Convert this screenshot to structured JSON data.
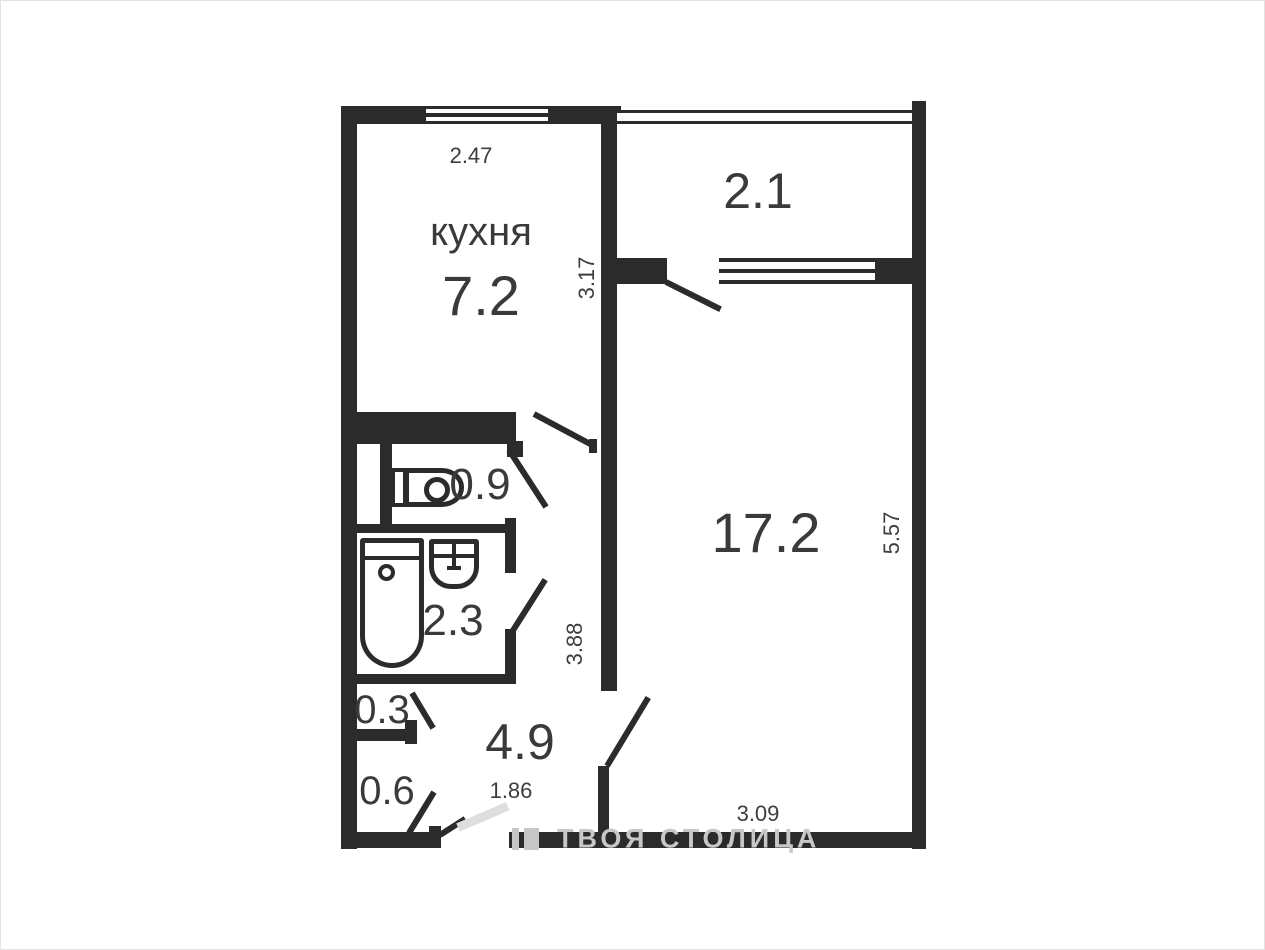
{
  "rooms": {
    "kitchen": {
      "label": "кухня",
      "area": "7.2"
    },
    "balcony": {
      "area": "2.1"
    },
    "living_room": {
      "area": "17.2"
    },
    "wc": {
      "area": "0.9"
    },
    "bathroom": {
      "area": "2.3"
    },
    "closet_small": {
      "area": "0.3"
    },
    "closet": {
      "area": "0.6"
    },
    "hallway": {
      "area": "4.9"
    }
  },
  "dimensions": {
    "kitchen_width": "2.47",
    "kitchen_depth": "3.17",
    "living_depth": "5.57",
    "living_width": "3.09",
    "hallway_depth": "3.88",
    "hallway_width": "1.86"
  },
  "watermark": {
    "text": "ТВОЯ СТОЛИЦА"
  },
  "icons": {
    "toilet": "toilet-side-icon",
    "bathtub": "bathtub-icon",
    "sink": "sink-icon"
  },
  "colors": {
    "wall": "#2b2b2b",
    "label": "#3a3a3a",
    "dim": "#3d3d3d",
    "watermark": "#c7c7c7",
    "door_grey": "#dedede"
  }
}
